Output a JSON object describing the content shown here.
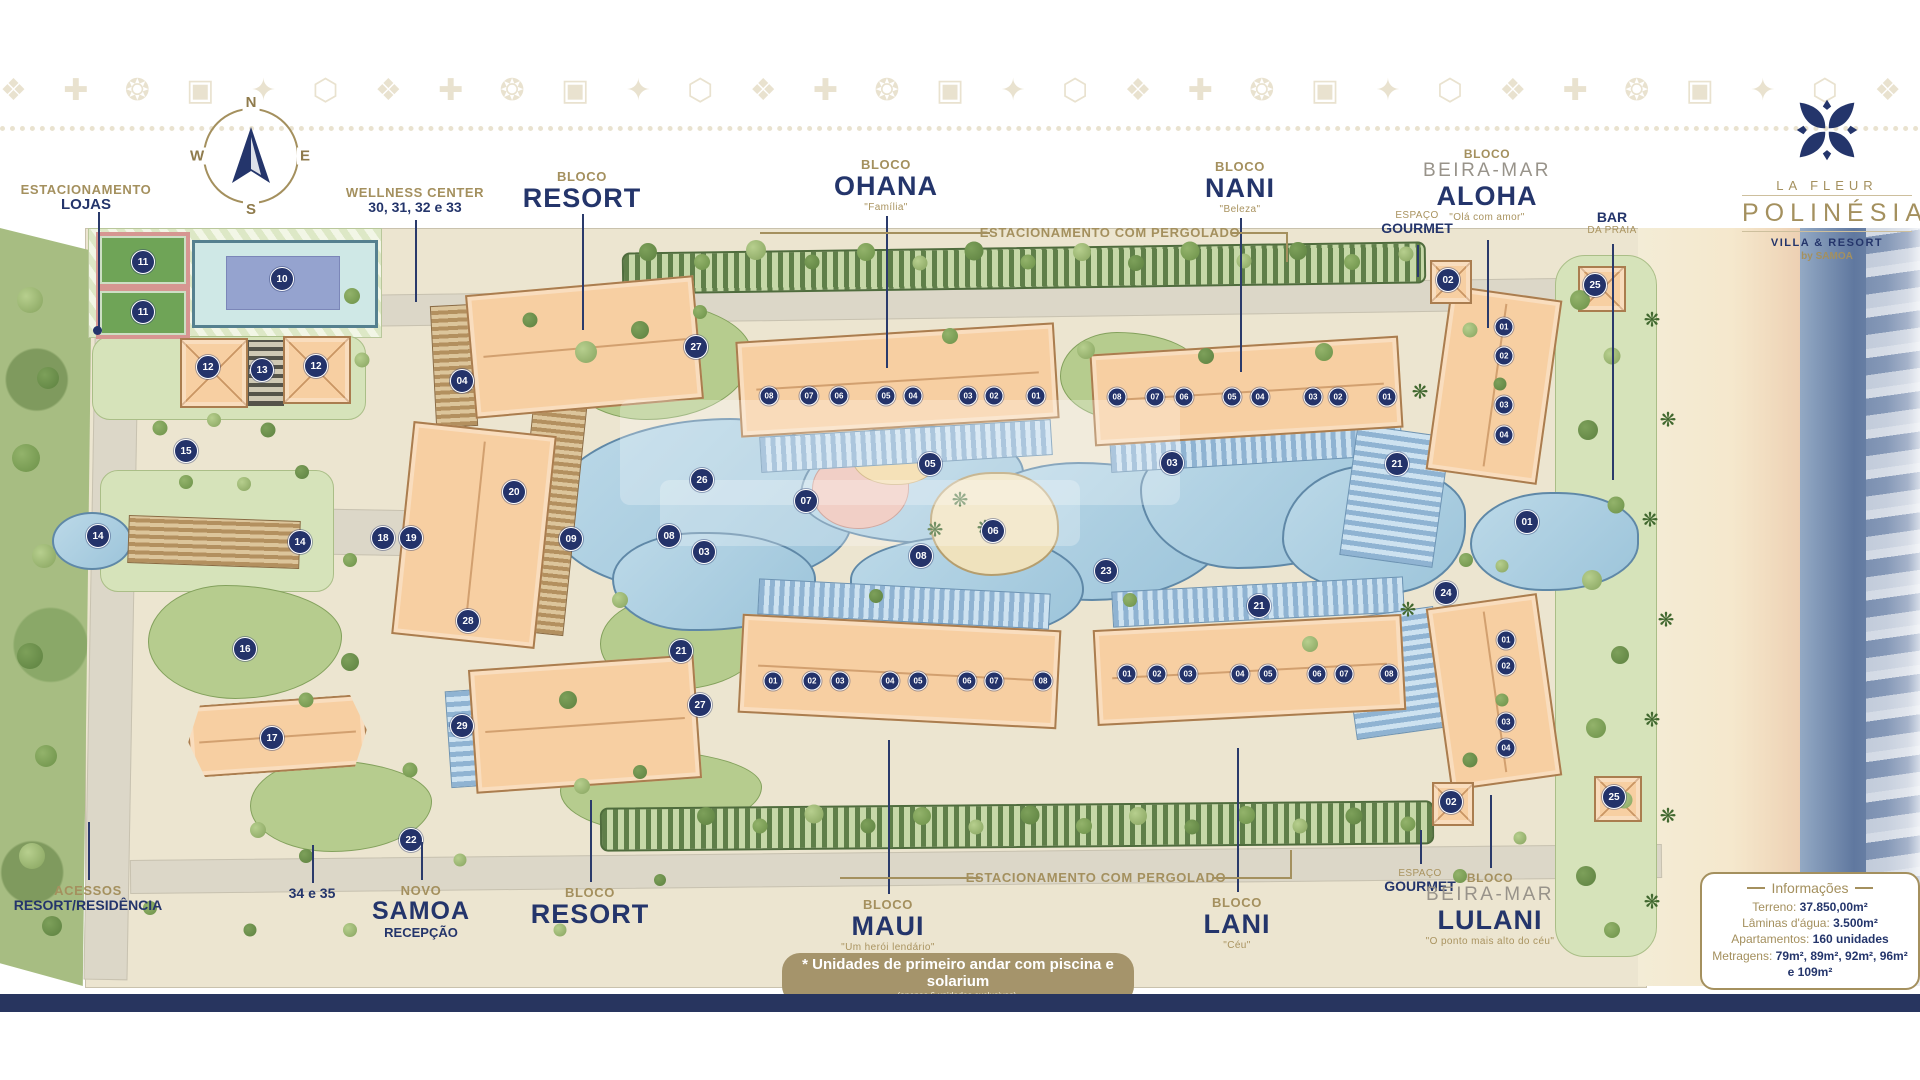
{
  "brand": {
    "la_fleur": "LA FLEUR",
    "name": "POLINÉSIA",
    "tagline": "VILLA & RESORT",
    "by": "by SAMOA"
  },
  "compass": {
    "n": "N",
    "e": "E",
    "s": "S",
    "w": "W"
  },
  "labels": {
    "lojas": {
      "top": "ESTACIONAMENTO",
      "name": "LOJAS"
    },
    "wellness": {
      "top": "WELLNESS CENTER",
      "name": "30, 31, 32 e 33"
    },
    "resort_top": {
      "top": "BLOCO",
      "name": "RESORT"
    },
    "ohana": {
      "top": "BLOCO",
      "name": "OHANA",
      "sub": "\"Família\""
    },
    "nani": {
      "top": "BLOCO",
      "name": "NANI",
      "sub": "\"Beleza\""
    },
    "aloha": {
      "top": "BLOCO",
      "mid": "BEIRA-MAR",
      "name": "ALOHA",
      "sub": "\"Olá com amor\""
    },
    "gourmet_top": {
      "top": "ESPAÇO",
      "name": "GOURMET"
    },
    "bar": {
      "name": "BAR",
      "sub": "DA PRAIA"
    },
    "pergolado_top": "ESTACIONAMENTO COM PERGOLADO",
    "pergolado_bottom": "ESTACIONAMENTO COM PERGOLADO",
    "acessos": {
      "top": "ACESSOS",
      "name": "RESORT/RESIDÊNCIA"
    },
    "b3435": "34 e 35",
    "samoa": {
      "top": "NOVO",
      "name": "SAMOA",
      "sub2": "RECEPÇÃO"
    },
    "resort_bottom": {
      "top": "BLOCO",
      "name": "RESORT"
    },
    "maui": {
      "top": "BLOCO",
      "name": "MAUI",
      "sub": "\"Um herói lendário\""
    },
    "lani": {
      "top": "BLOCO",
      "name": "LANI",
      "sub": "\"Céu\""
    },
    "gourmet_bottom": {
      "top": "ESPAÇO",
      "name": "GOURMET"
    },
    "lulani": {
      "top": "BLOCO",
      "mid": "BEIRA-MAR",
      "name": "LULANI",
      "sub": "\"O ponto mais alto do céu\""
    }
  },
  "info": {
    "title": "Informações",
    "rows": [
      {
        "label": "Terreno: ",
        "value": "37.850,00m²"
      },
      {
        "label": "Lâminas d'água: ",
        "value": "3.500m²"
      },
      {
        "label": "Apartamentos: ",
        "value": "160 unidades"
      },
      {
        "label": "Metragens: ",
        "value": "79m², 89m², 92m², 96m² e 109m²"
      }
    ]
  },
  "footnote": {
    "line1": "* Unidades de primeiro andar com piscina e solarium",
    "line2": "(apenas 6 unidades exclusivas)."
  },
  "colors": {
    "navy": "#24356b",
    "gold": "#a4905e",
    "building": "#f7cfa2",
    "pool": "#9cc4da",
    "lawn": "#b6cc8e",
    "sand": "#f3ecd6",
    "sea": "#60789f"
  },
  "badges": [
    {
      "n": "11",
      "x": 143,
      "y": 262
    },
    {
      "n": "11",
      "x": 143,
      "y": 312
    },
    {
      "n": "10",
      "x": 282,
      "y": 279
    },
    {
      "n": "12",
      "x": 208,
      "y": 367
    },
    {
      "n": "13",
      "x": 262,
      "y": 370
    },
    {
      "n": "12",
      "x": 316,
      "y": 366
    },
    {
      "n": "15",
      "x": 186,
      "y": 451
    },
    {
      "n": "14",
      "x": 98,
      "y": 536
    },
    {
      "n": "14",
      "x": 300,
      "y": 542
    },
    {
      "n": "16",
      "x": 245,
      "y": 649
    },
    {
      "n": "17",
      "x": 272,
      "y": 738
    },
    {
      "n": "22",
      "x": 411,
      "y": 840
    },
    {
      "n": "04",
      "x": 462,
      "y": 381
    },
    {
      "n": "18",
      "x": 383,
      "y": 538
    },
    {
      "n": "19",
      "x": 411,
      "y": 538
    },
    {
      "n": "20",
      "x": 514,
      "y": 492
    },
    {
      "n": "28",
      "x": 468,
      "y": 621
    },
    {
      "n": "29",
      "x": 462,
      "y": 726
    },
    {
      "n": "21",
      "x": 681,
      "y": 651
    },
    {
      "n": "27",
      "x": 696,
      "y": 347
    },
    {
      "n": "26",
      "x": 702,
      "y": 480
    },
    {
      "n": "09",
      "x": 571,
      "y": 539
    },
    {
      "n": "08",
      "x": 669,
      "y": 536
    },
    {
      "n": "03",
      "x": 704,
      "y": 552
    },
    {
      "n": "27",
      "x": 700,
      "y": 705
    },
    {
      "n": "05",
      "x": 930,
      "y": 464
    },
    {
      "n": "07",
      "x": 806,
      "y": 501
    },
    {
      "n": "06",
      "x": 993,
      "y": 531
    },
    {
      "n": "08",
      "x": 921,
      "y": 556
    },
    {
      "n": "03",
      "x": 1172,
      "y": 463
    },
    {
      "n": "23",
      "x": 1106,
      "y": 571
    },
    {
      "n": "21",
      "x": 1259,
      "y": 606
    },
    {
      "n": "21",
      "x": 1397,
      "y": 464
    },
    {
      "n": "24",
      "x": 1446,
      "y": 593
    },
    {
      "n": "01",
      "x": 1527,
      "y": 522
    },
    {
      "n": "02",
      "x": 1448,
      "y": 280
    },
    {
      "n": "25",
      "x": 1595,
      "y": 285
    },
    {
      "n": "02",
      "x": 1451,
      "y": 802
    },
    {
      "n": "25",
      "x": 1614,
      "y": 797
    },
    {
      "n": "08",
      "x": 769,
      "y": 396,
      "sm": 1
    },
    {
      "n": "07",
      "x": 809,
      "y": 396,
      "sm": 1
    },
    {
      "n": "06",
      "x": 839,
      "y": 396,
      "sm": 1
    },
    {
      "n": "05",
      "x": 886,
      "y": 396,
      "sm": 1
    },
    {
      "n": "04",
      "x": 913,
      "y": 396,
      "sm": 1
    },
    {
      "n": "03",
      "x": 968,
      "y": 396,
      "sm": 1
    },
    {
      "n": "02",
      "x": 994,
      "y": 396,
      "sm": 1
    },
    {
      "n": "01",
      "x": 1036,
      "y": 396,
      "sm": 1
    },
    {
      "n": "08",
      "x": 1117,
      "y": 397,
      "sm": 1
    },
    {
      "n": "07",
      "x": 1155,
      "y": 397,
      "sm": 1
    },
    {
      "n": "06",
      "x": 1184,
      "y": 397,
      "sm": 1
    },
    {
      "n": "05",
      "x": 1232,
      "y": 397,
      "sm": 1
    },
    {
      "n": "04",
      "x": 1260,
      "y": 397,
      "sm": 1
    },
    {
      "n": "03",
      "x": 1313,
      "y": 397,
      "sm": 1
    },
    {
      "n": "02",
      "x": 1338,
      "y": 397,
      "sm": 1
    },
    {
      "n": "01",
      "x": 1387,
      "y": 397,
      "sm": 1
    },
    {
      "n": "01",
      "x": 1504,
      "y": 327,
      "sm": 1
    },
    {
      "n": "02",
      "x": 1504,
      "y": 356,
      "sm": 1
    },
    {
      "n": "03",
      "x": 1504,
      "y": 405,
      "sm": 1
    },
    {
      "n": "04",
      "x": 1504,
      "y": 435,
      "sm": 1
    },
    {
      "n": "01",
      "x": 773,
      "y": 681,
      "sm": 1
    },
    {
      "n": "02",
      "x": 812,
      "y": 681,
      "sm": 1
    },
    {
      "n": "03",
      "x": 840,
      "y": 681,
      "sm": 1
    },
    {
      "n": "04",
      "x": 890,
      "y": 681,
      "sm": 1
    },
    {
      "n": "05",
      "x": 918,
      "y": 681,
      "sm": 1
    },
    {
      "n": "06",
      "x": 967,
      "y": 681,
      "sm": 1
    },
    {
      "n": "07",
      "x": 994,
      "y": 681,
      "sm": 1
    },
    {
      "n": "08",
      "x": 1043,
      "y": 681,
      "sm": 1
    },
    {
      "n": "01",
      "x": 1127,
      "y": 674,
      "sm": 1
    },
    {
      "n": "02",
      "x": 1157,
      "y": 674,
      "sm": 1
    },
    {
      "n": "03",
      "x": 1188,
      "y": 674,
      "sm": 1
    },
    {
      "n": "04",
      "x": 1240,
      "y": 674,
      "sm": 1
    },
    {
      "n": "05",
      "x": 1268,
      "y": 674,
      "sm": 1
    },
    {
      "n": "06",
      "x": 1317,
      "y": 674,
      "sm": 1
    },
    {
      "n": "07",
      "x": 1344,
      "y": 674,
      "sm": 1
    },
    {
      "n": "08",
      "x": 1389,
      "y": 674,
      "sm": 1
    },
    {
      "n": "01",
      "x": 1506,
      "y": 640,
      "sm": 1
    },
    {
      "n": "02",
      "x": 1506,
      "y": 666,
      "sm": 1
    },
    {
      "n": "03",
      "x": 1506,
      "y": 722,
      "sm": 1
    },
    {
      "n": "04",
      "x": 1506,
      "y": 748,
      "sm": 1
    }
  ]
}
